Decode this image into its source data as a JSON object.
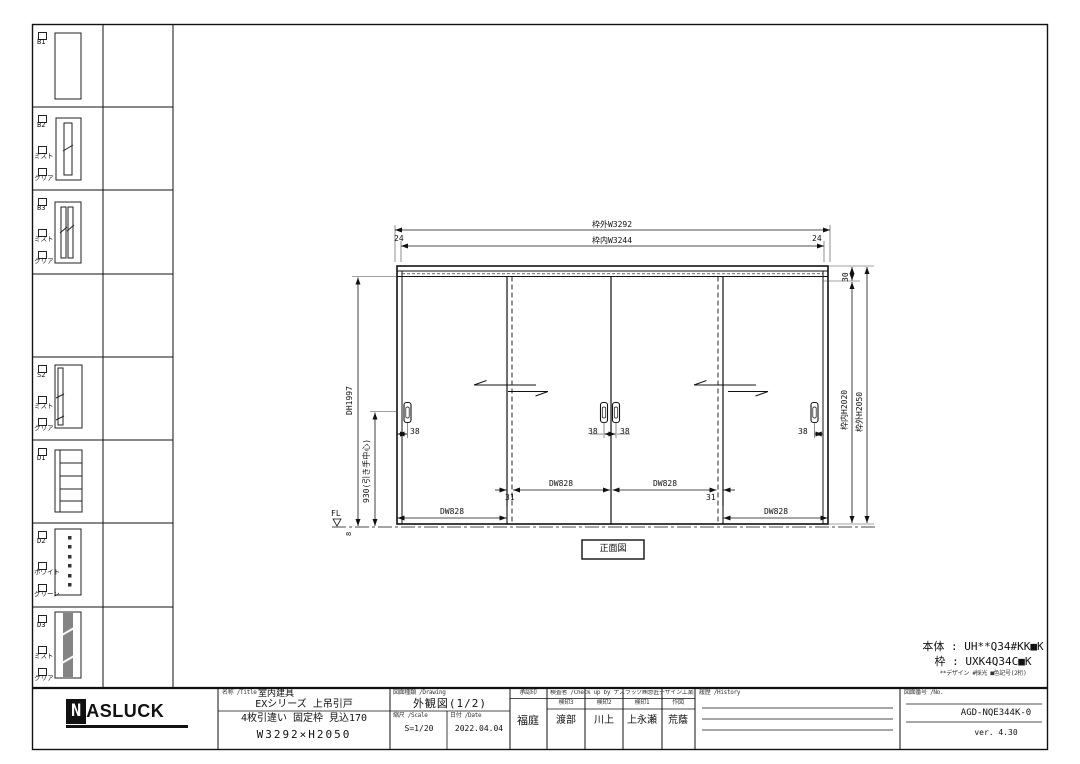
{
  "left_panel": {
    "rows": [
      {
        "code": "B1",
        "options": []
      },
      {
        "code": "B2",
        "options": [
          "ミスト",
          "クリア"
        ]
      },
      {
        "code": "B3",
        "options": [
          "ミスト",
          "クリア"
        ]
      },
      {
        "code": "",
        "options": []
      },
      {
        "code": "S2",
        "options": [
          "ミスト",
          "クリア"
        ]
      },
      {
        "code": "D1",
        "options": []
      },
      {
        "code": "D2",
        "options": [
          "ホワイト",
          "グリーン"
        ]
      },
      {
        "code": "D3",
        "options": [
          "ミスト",
          "クリア"
        ]
      }
    ]
  },
  "drawing": {
    "dim_frame_outer_w": "枠外W3292",
    "dim_frame_inner_w": "枠内W3244",
    "dim_jamb_left": "24",
    "dim_jamb_right": "24",
    "dim_head": "30",
    "dim_frame_inner_h": "枠内H2020",
    "dim_frame_outer_h": "枠外H2050",
    "dim_door_h": "DH1997",
    "dim_handle_center": "930(引き手中心)",
    "floor_line": "FL",
    "dim_floor_gap": "8",
    "dim_handle_offset": "38",
    "dim_door_w": "DW828",
    "dim_overlap": "31",
    "view_label": "正面図"
  },
  "notes": {
    "body": "本体 : UH**Q34#KK■K",
    "frame": "枠 : UXK4Q34C■K",
    "legend": "**デザイン #採光 ■色記号(2桁)"
  },
  "title_block": {
    "logo_n": "N",
    "logo_rest": "ASLUCK",
    "name_header": "名称 /Title",
    "category": "室内建具",
    "series": "EXシリーズ 上吊引戸",
    "spec": "4枚引違い 固定枠 見込170",
    "size": "W3292×H2050",
    "drawing_header": "図面種類 /Drawing",
    "drawing_type": "外観図(1/2)",
    "scale_header": "縮尺 /Scale",
    "scale": "S=1/20",
    "date_header": "日付 /Date",
    "date": "2022.04.04",
    "approval_header": "承認印",
    "approver": "福庭",
    "check_header": "検査者 /Check up by ナスラック㈱意匠デザイン工業部",
    "stamp_headers": [
      "検印3",
      "検印2",
      "検印1",
      "作図"
    ],
    "checkers": [
      "渡部",
      "川上",
      "上永瀬",
      "荒蔭"
    ],
    "history_header": "履歴 /History",
    "number_header": "図面番号 /No.",
    "drawing_number": "AGD-NQE344K-0",
    "version": "ver. 4.30"
  }
}
